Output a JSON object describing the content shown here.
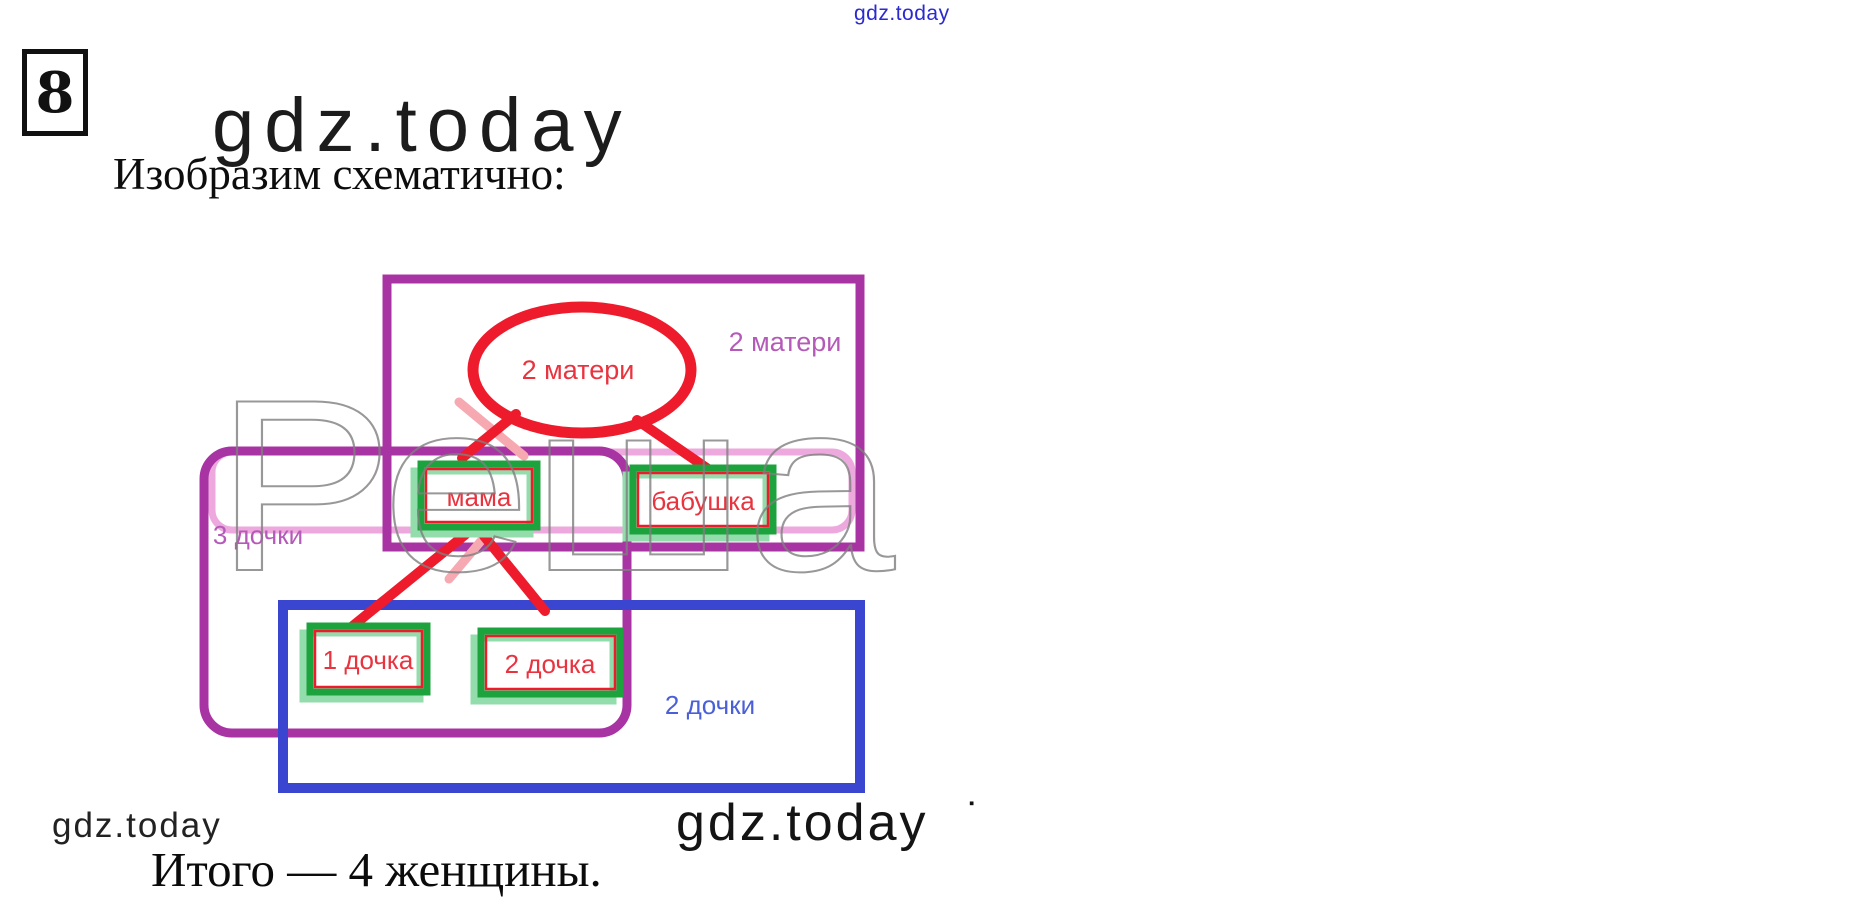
{
  "header": {
    "top_watermark": "gdz.today",
    "problem_number": "8",
    "site_logo": "gdz.today",
    "intro_text": "Изобразим схематично:"
  },
  "diagram": {
    "overlay_watermark": "Реша",
    "sets": {
      "mothers_rect_label": "2 матери",
      "mothers_ellipse_label": "2 матери",
      "daughters_round_label": "3 дочки",
      "daughters_blue_label": "2 дочки"
    },
    "nodes": {
      "mama": "мама",
      "grandma": "бабушка",
      "daughter1": "1 дочка",
      "daughter2": "2 дочка"
    }
  },
  "footer": {
    "left_watermark": "gdz.today",
    "center_watermark": "gdz.today",
    "center_watermark_mark": "▪",
    "conclusion_text": "Итого — 4 женщины."
  },
  "colors": {
    "purple": "#a834a3",
    "orchid_label": "#b45ab8",
    "pink_round": "#eda9de",
    "pink_line": "#f7a9b2",
    "blue": "#3a46cf",
    "blue_label": "#4a5fd8",
    "green": "#1da33d",
    "mint": "#93dcab",
    "red": "#ee1b2c",
    "red_text": "#e9333f",
    "watermark_gray": "#7f7f7f",
    "top_watermark_blue": "#2a2ad0"
  }
}
